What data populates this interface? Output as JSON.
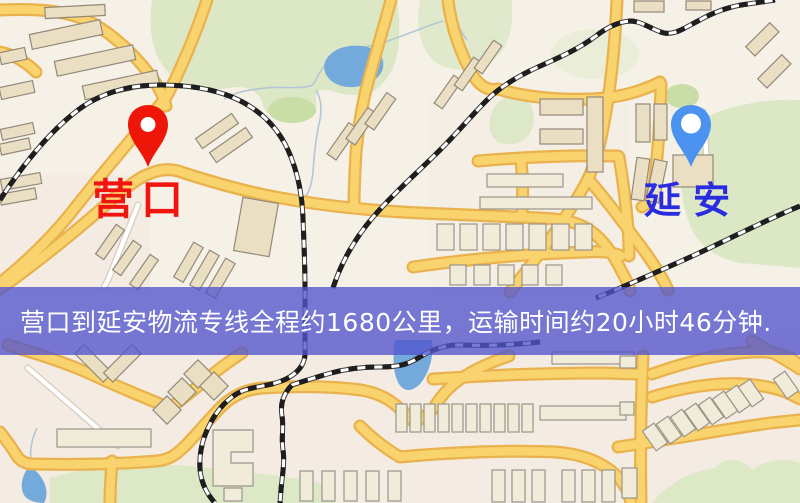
{
  "banner": {
    "text": "营口到延安物流专线全程约1680公里，运输时间约20小时46分钟.",
    "background_color": "#5254cd",
    "text_color": "#ffffff"
  },
  "markers": {
    "origin": {
      "label": "营口",
      "label_color": "#f0160f",
      "pin_color": "#ee1509",
      "icon": "red-map-pin-icon"
    },
    "destination": {
      "label": "延安",
      "label_color": "#2a2ce0",
      "pin_color": "#4c92f0",
      "icon": "blue-map-pin-icon"
    }
  },
  "map": {
    "style": "street-map",
    "background_color": "#f6f1e7",
    "road_color": "#f9d36e",
    "road_casing_color": "#e9b24d",
    "park_color": "#dce8c5",
    "water_color": "#74a9dc",
    "building_color": "#eadfc3",
    "railway_color": "#1e1e1e"
  }
}
